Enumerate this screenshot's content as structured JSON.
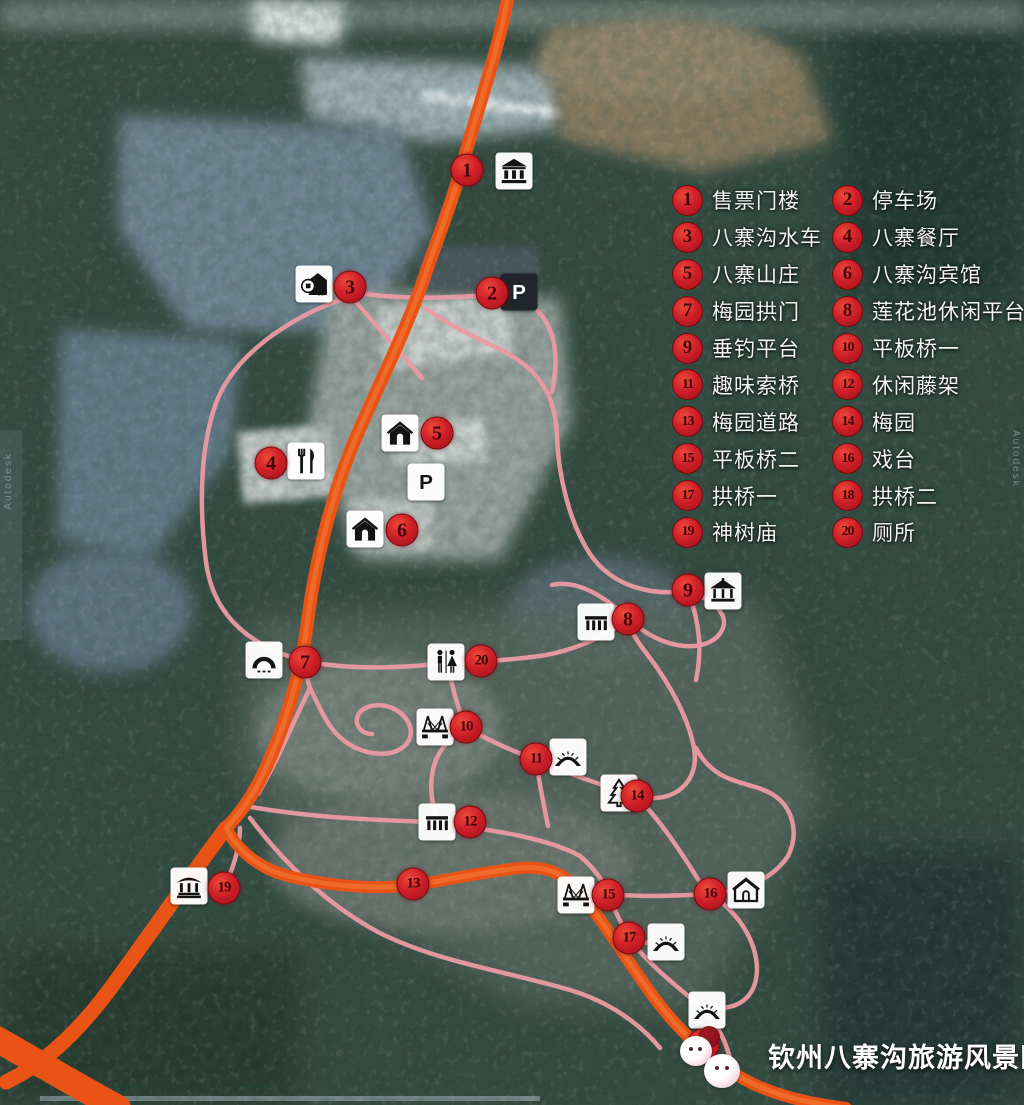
{
  "footer": {
    "title": "钦州八寨沟旅游风景区"
  },
  "legend": {
    "items": [
      {
        "num": "1",
        "label": "售票门楼"
      },
      {
        "num": "2",
        "label": "停车场"
      },
      {
        "num": "3",
        "label": "八寨沟水车"
      },
      {
        "num": "4",
        "label": "八寨餐厅"
      },
      {
        "num": "5",
        "label": "八寨山庄"
      },
      {
        "num": "6",
        "label": "八寨沟宾馆"
      },
      {
        "num": "7",
        "label": "梅园拱门"
      },
      {
        "num": "8",
        "label": "莲花池休闲平台"
      },
      {
        "num": "9",
        "label": "垂钓平台"
      },
      {
        "num": "10",
        "label": "平板桥一"
      },
      {
        "num": "11",
        "label": "趣味索桥"
      },
      {
        "num": "12",
        "label": "休闲藤架"
      },
      {
        "num": "13",
        "label": "梅园道路"
      },
      {
        "num": "14",
        "label": "梅园"
      },
      {
        "num": "15",
        "label": "平板桥二"
      },
      {
        "num": "16",
        "label": "戏台"
      },
      {
        "num": "17",
        "label": "拱桥一"
      },
      {
        "num": "18",
        "label": "拱桥二"
      },
      {
        "num": "19",
        "label": "神树庙"
      },
      {
        "num": "20",
        "label": "厕所"
      }
    ]
  },
  "markers": [
    {
      "num": "1",
      "label": "售票门楼",
      "x": 467,
      "y": 170,
      "icon": "gate-building-icon",
      "ix": 514,
      "iy": 171
    },
    {
      "num": "2",
      "label": "停车场",
      "x": 492,
      "y": 293,
      "icon": "parking-dark-icon",
      "ix": 519,
      "iy": 292
    },
    {
      "num": "3",
      "label": "八寨沟水车",
      "x": 350,
      "y": 287,
      "icon": "water-wheel-icon",
      "ix": 314,
      "iy": 284
    },
    {
      "num": "4",
      "label": "八寨餐厅",
      "x": 271,
      "y": 463,
      "icon": "restaurant-icon",
      "ix": 306,
      "iy": 461
    },
    {
      "num": "5",
      "label": "八寨山庄",
      "x": 437,
      "y": 433,
      "icon": "house-icon",
      "ix": 400,
      "iy": 433
    },
    {
      "num": "6",
      "label": "八寨沟宾馆",
      "x": 402,
      "y": 530,
      "icon": "house-icon",
      "ix": 365,
      "iy": 529
    },
    {
      "num": "7",
      "label": "梅园拱门",
      "x": 305,
      "y": 662,
      "icon": "arch-gate-icon",
      "ix": 264,
      "iy": 660
    },
    {
      "num": "8",
      "label": "莲花池休闲平台",
      "x": 628,
      "y": 619,
      "icon": "platform-icon",
      "ix": 596,
      "iy": 622
    },
    {
      "num": "9",
      "label": "垂钓平台",
      "x": 688,
      "y": 590,
      "icon": "pavilion-icon",
      "ix": 723,
      "iy": 591
    },
    {
      "num": "10",
      "label": "平板桥一",
      "x": 466,
      "y": 727,
      "icon": "flat-bridge-icon",
      "ix": 435,
      "iy": 727
    },
    {
      "num": "11",
      "label": "趣味索桥",
      "x": 536,
      "y": 759,
      "icon": "arch-bridge-icon",
      "ix": 568,
      "iy": 757
    },
    {
      "num": "12",
      "label": "休闲藤架",
      "x": 470,
      "y": 822,
      "icon": "platform-icon",
      "ix": 437,
      "iy": 822
    },
    {
      "num": "13",
      "label": "梅园道路",
      "x": 413,
      "y": 884,
      "icon": null
    },
    {
      "num": "14",
      "label": "梅园",
      "x": 637,
      "y": 796,
      "icon": "tree-icon",
      "ix": 619,
      "iy": 793
    },
    {
      "num": "15",
      "label": "平板桥二",
      "x": 608,
      "y": 895,
      "icon": "flat-bridge-icon",
      "ix": 576,
      "iy": 895
    },
    {
      "num": "16",
      "label": "戏台",
      "x": 710,
      "y": 894,
      "icon": "house-outline-icon",
      "ix": 746,
      "iy": 890
    },
    {
      "num": "17",
      "label": "拱桥一",
      "x": 629,
      "y": 938,
      "icon": "arch-bridge-icon",
      "ix": 666,
      "iy": 942
    },
    {
      "num": "18",
      "label": "拱桥二",
      "x": 703,
      "y": 1045,
      "icon": "arch-bridge-icon",
      "ix": 707,
      "iy": 1010
    },
    {
      "num": "19",
      "label": "神树庙",
      "x": 224,
      "y": 888,
      "icon": "temple-icon",
      "ix": 189,
      "iy": 886
    },
    {
      "num": "20",
      "label": "厕所",
      "x": 481,
      "y": 661,
      "icon": "toilet-icon",
      "ix": 446,
      "iy": 662
    }
  ],
  "standalone_icons": [
    {
      "icon": "parking-light-icon",
      "ix": 426,
      "iy": 482
    }
  ],
  "watermarks": {
    "left": "Autodesk",
    "right": "Autodesk"
  },
  "colors": {
    "road_orange": "#e95316",
    "trail_pink": "#eb9aa3",
    "marker_red": "#cf2028",
    "legend_text": "#f2f4f2",
    "water": "#6e8494",
    "forest": "#33493f"
  }
}
